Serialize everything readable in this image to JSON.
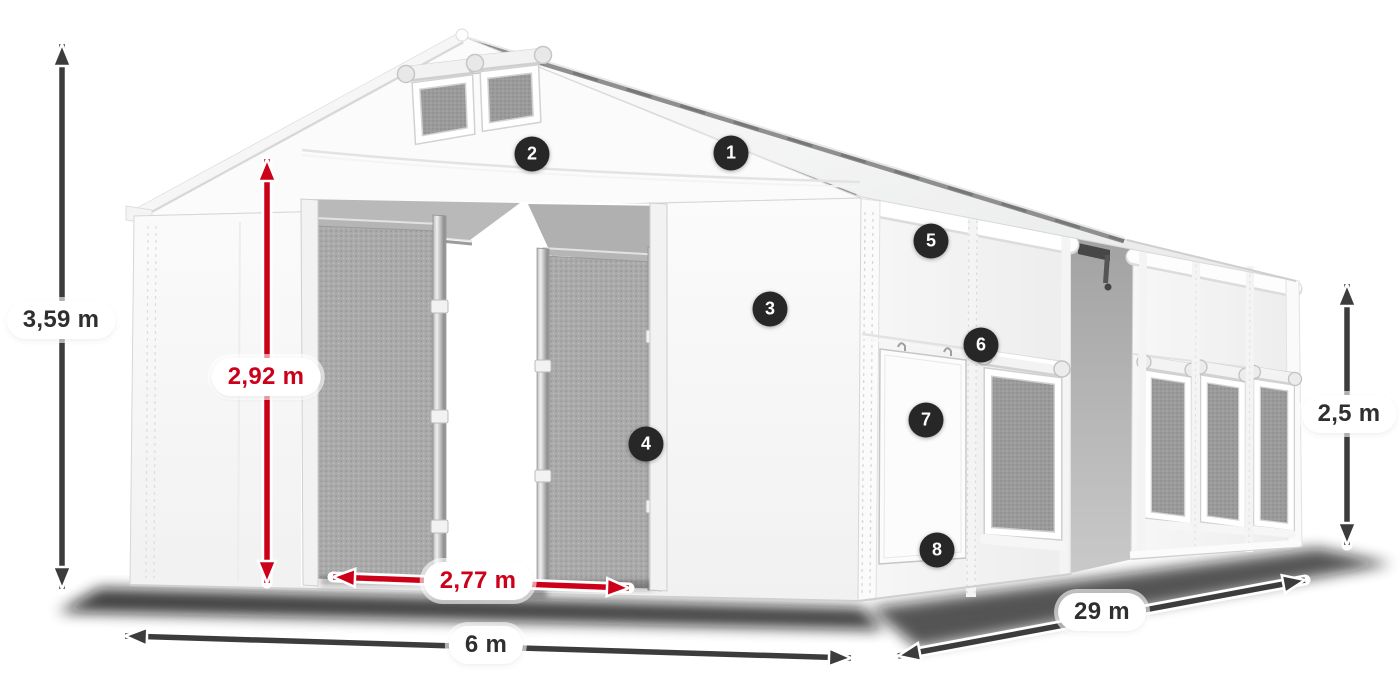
{
  "diagram": {
    "dimension_labels": {
      "total_height": "3,59 m",
      "entrance_height": "2,92 m",
      "entrance_width": "2,77 m",
      "front_width": "6 m",
      "side_length": "29 m",
      "wall_height": "2,5 m"
    },
    "callout_numbers": [
      "1",
      "2",
      "3",
      "4",
      "5",
      "6",
      "7",
      "8"
    ],
    "colors": {
      "dimension_red": "#cc0019",
      "dimension_dark": "#3c3c3c",
      "badge_background": "#272727",
      "badge_text": "#ffffff",
      "label_pill_background": "#ffffff"
    }
  }
}
